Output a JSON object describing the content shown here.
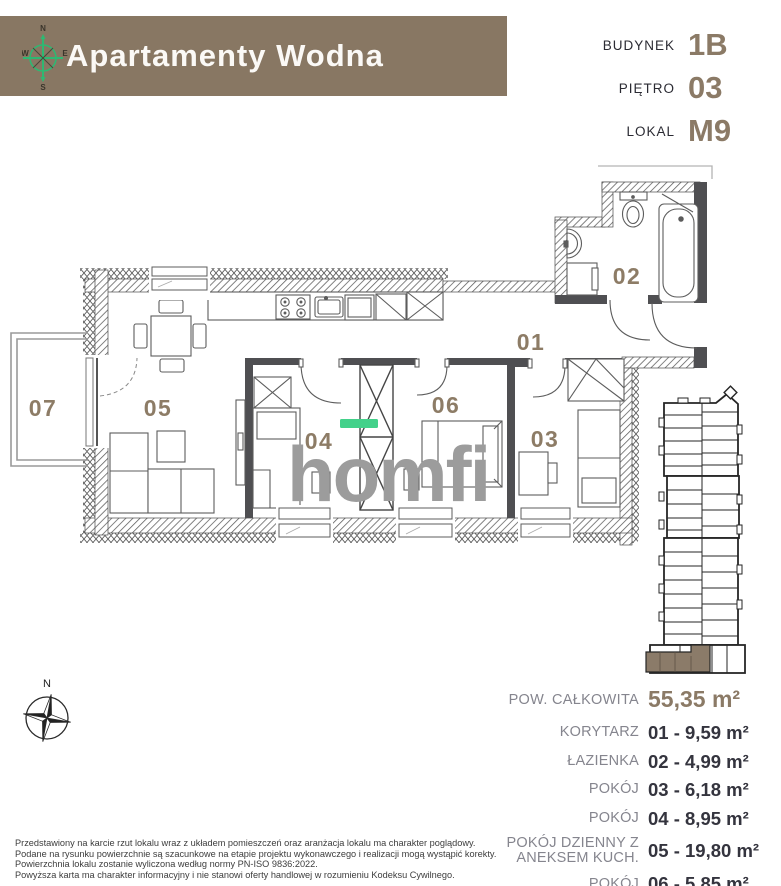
{
  "header": {
    "title": "Apartamenty Wodna",
    "compass": {
      "n": "N",
      "e": "E",
      "s": "S",
      "w": "W"
    }
  },
  "unit_info": {
    "rows": [
      {
        "label": "BUDYNEK",
        "value": "1B"
      },
      {
        "label": "PIĘTRO",
        "value": "03"
      },
      {
        "label": "LOKAL",
        "value": "M9"
      }
    ]
  },
  "floorplan": {
    "rooms": {
      "r01": "01",
      "r02": "02",
      "r03": "03",
      "r04": "04",
      "r05": "05",
      "r06": "06",
      "r07": "07"
    },
    "watermark": {
      "text": "homfi",
      "accent_color": "#43d18a",
      "gray": "#9c9c9c"
    }
  },
  "areas": {
    "total": {
      "label": "POW. CAŁKOWITA",
      "value": "55,35 m²"
    },
    "rows": [
      {
        "label": "KORYTARZ",
        "value": "01 - 9,59 m²"
      },
      {
        "label": "ŁAZIENKA",
        "value": "02 - 4,99 m²"
      },
      {
        "label": "POKÓJ",
        "value": "03 - 6,18 m²"
      },
      {
        "label": "POKÓJ",
        "value": "04 - 8,95 m²"
      },
      {
        "label": "POKÓJ DZIENNY Z ANEKSEM KUCH.",
        "value": "05 - 19,80 m²"
      },
      {
        "label": "POKÓJ",
        "value": "06 - 5,85 m²"
      },
      {
        "label": "BALKON",
        "value": "07 ~ 4,00 m²"
      }
    ]
  },
  "site_compass": {
    "north": "N"
  },
  "disclaimer": {
    "lines": [
      "Przedstawiony na karcie rzut lokalu wraz z układem pomieszczeń oraz aranżacja lokalu ma charakter poglądowy.",
      "Podane na rysunku powierzchnie są szacunkowe na etapie projektu wykonawczego i realizacji mogą wystąpić korekty.",
      "Powierzchnia lokalu zostanie wyliczona według normy PN-ISO 9836:2022.",
      "Powyższa karta ma charakter informacyjny i nie stanowi oferty handlowej w rozumieniu Kodeksu Cywilnego."
    ]
  },
  "colors": {
    "brand_brown": "#887763",
    "value_brown": "#8b7a66",
    "text_dark": "#34343e",
    "label_gray": "#85858e",
    "logo_gray": "#9c9c9c",
    "logo_green": "#43d18a",
    "compass_green": "#2eb872"
  }
}
